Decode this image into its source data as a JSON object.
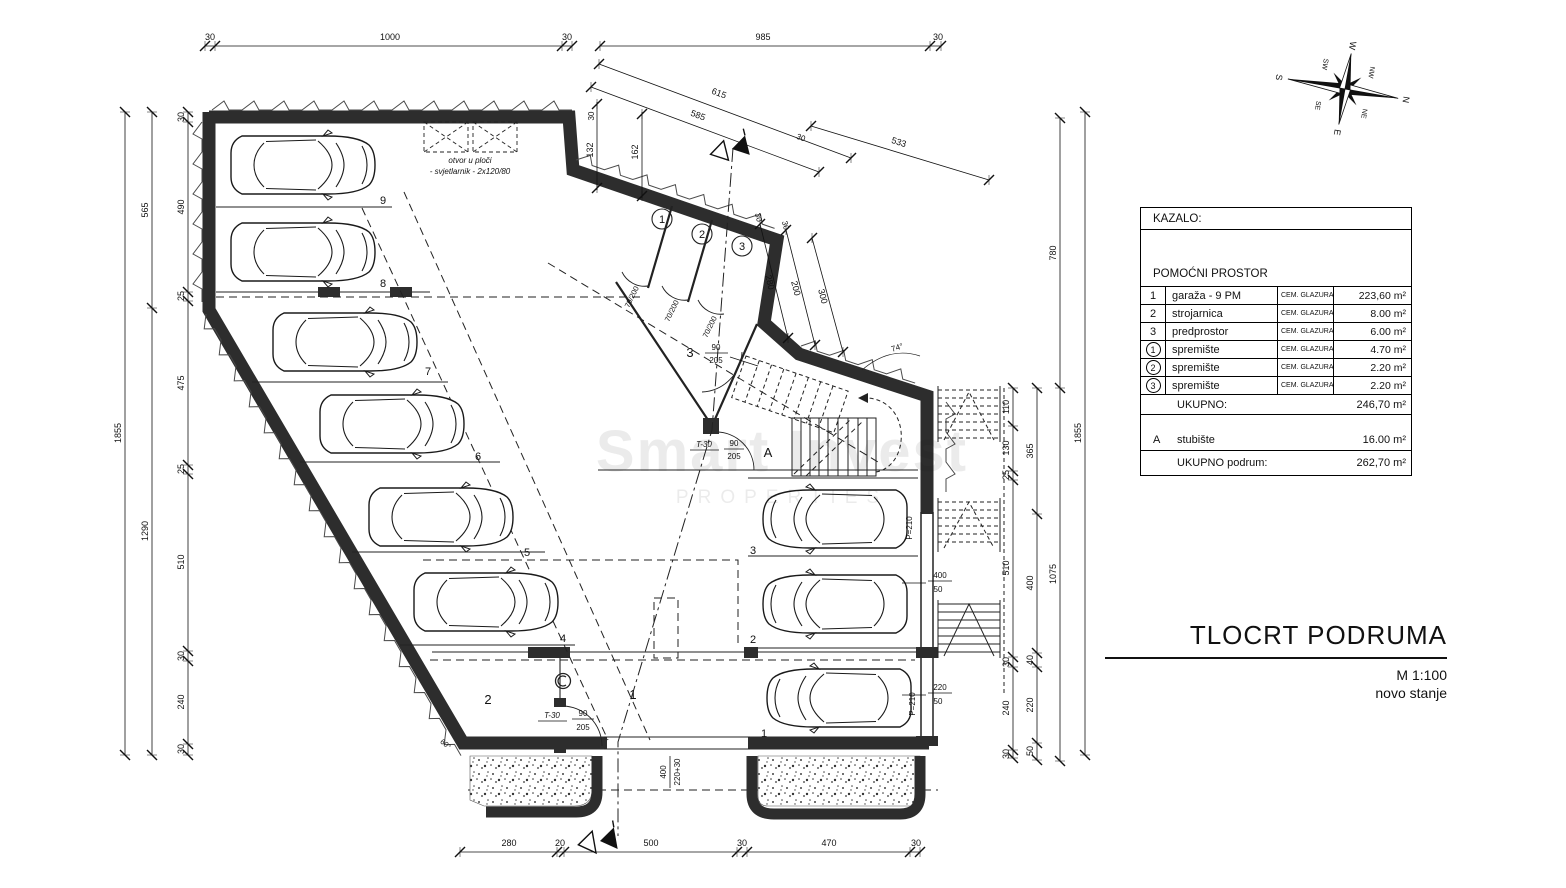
{
  "title_block": {
    "title": "TLOCRT PODRUMA",
    "scale": "M 1:100",
    "status": "novo stanje"
  },
  "watermark": {
    "line1": "Smart Invest",
    "line2": "PROPERTIES"
  },
  "compass": {
    "n": "N",
    "ne": "NE",
    "e": "E",
    "se": "SE",
    "s": "S",
    "sw": "SW",
    "w": "W",
    "nw": "NW"
  },
  "legend": {
    "header": "KAZALO:",
    "section": "POMOĆNI PROSTOR",
    "rows": [
      {
        "no": "1",
        "name": "garaža - 9 PM",
        "finish": "CEM. GLAZURA",
        "area": "223,60 m²"
      },
      {
        "no": "2",
        "name": "strojarnica",
        "finish": "CEM. GLAZURA",
        "area": "8.00 m²"
      },
      {
        "no": "3",
        "name": "predprostor",
        "finish": "CEM. GLAZURA",
        "area": "6.00 m²"
      },
      {
        "no": "1",
        "name": "spremište",
        "finish": "CEM. GLAZURA",
        "area": "4.70 m²"
      },
      {
        "no": "2",
        "name": "spremište",
        "finish": "CEM. GLAZURA",
        "area": "2.20 m²"
      },
      {
        "no": "3",
        "name": "spremište",
        "finish": "CEM. GLAZURA",
        "area": "2.20 m²"
      }
    ],
    "total_label": "UKUPNO:",
    "total_area": "246,70 m²",
    "stair_no": "A",
    "stair_name": "stubište",
    "stair_area": "16.00 m²",
    "grand_label": "UKUPNO podrum:",
    "grand_area": "262,70 m²"
  },
  "rooms": {
    "garage": "1",
    "boiler": "2",
    "hall": "3",
    "stair": "A",
    "s1": "1",
    "s2": "2",
    "s3": "3"
  },
  "parking": {
    "p1": "1",
    "p2": "2",
    "p3": "3",
    "p4": "4",
    "p5": "5",
    "p6": "6",
    "p7": "7",
    "p8": "8",
    "p9": "9"
  },
  "doors": {
    "t30": "T-30",
    "w90": "90",
    "h205": "205",
    "d70": "70/200"
  },
  "annotations": {
    "skylight1": "otvor u ploči",
    "skylight2": "- svjetlarnik - 2x120/80",
    "p210": "P=210",
    "a74": "74°",
    "a60": "60°"
  },
  "dims": {
    "top": [
      "30",
      "1000",
      "30",
      "985",
      "30"
    ],
    "bottom": [
      "280",
      "20",
      "500",
      "30",
      "470",
      "30"
    ],
    "li": [
      "30",
      "490",
      "25",
      "475",
      "25",
      "510",
      "30",
      "240",
      "30"
    ],
    "lm": [
      "565",
      "1290"
    ],
    "lo": "1855",
    "ri": [
      "110",
      "130",
      "25",
      "510",
      "30",
      "240",
      "30"
    ],
    "rm": [
      "365",
      "400",
      "40",
      "220",
      "50"
    ],
    "ro": [
      "780",
      "1075"
    ],
    "rx": "1855",
    "diag": [
      "615",
      "585",
      "533"
    ],
    "diag30": "30",
    "wing": [
      "30",
      "132",
      "162"
    ],
    "ramp": [
      "280",
      "200",
      "300"
    ],
    "ramp30": [
      "30",
      "30"
    ],
    "rs": {
      "a400": "400",
      "a50": "50",
      "a220": "220",
      "b50": "50"
    },
    "door": {
      "w": "400",
      "h": "220+30"
    }
  }
}
